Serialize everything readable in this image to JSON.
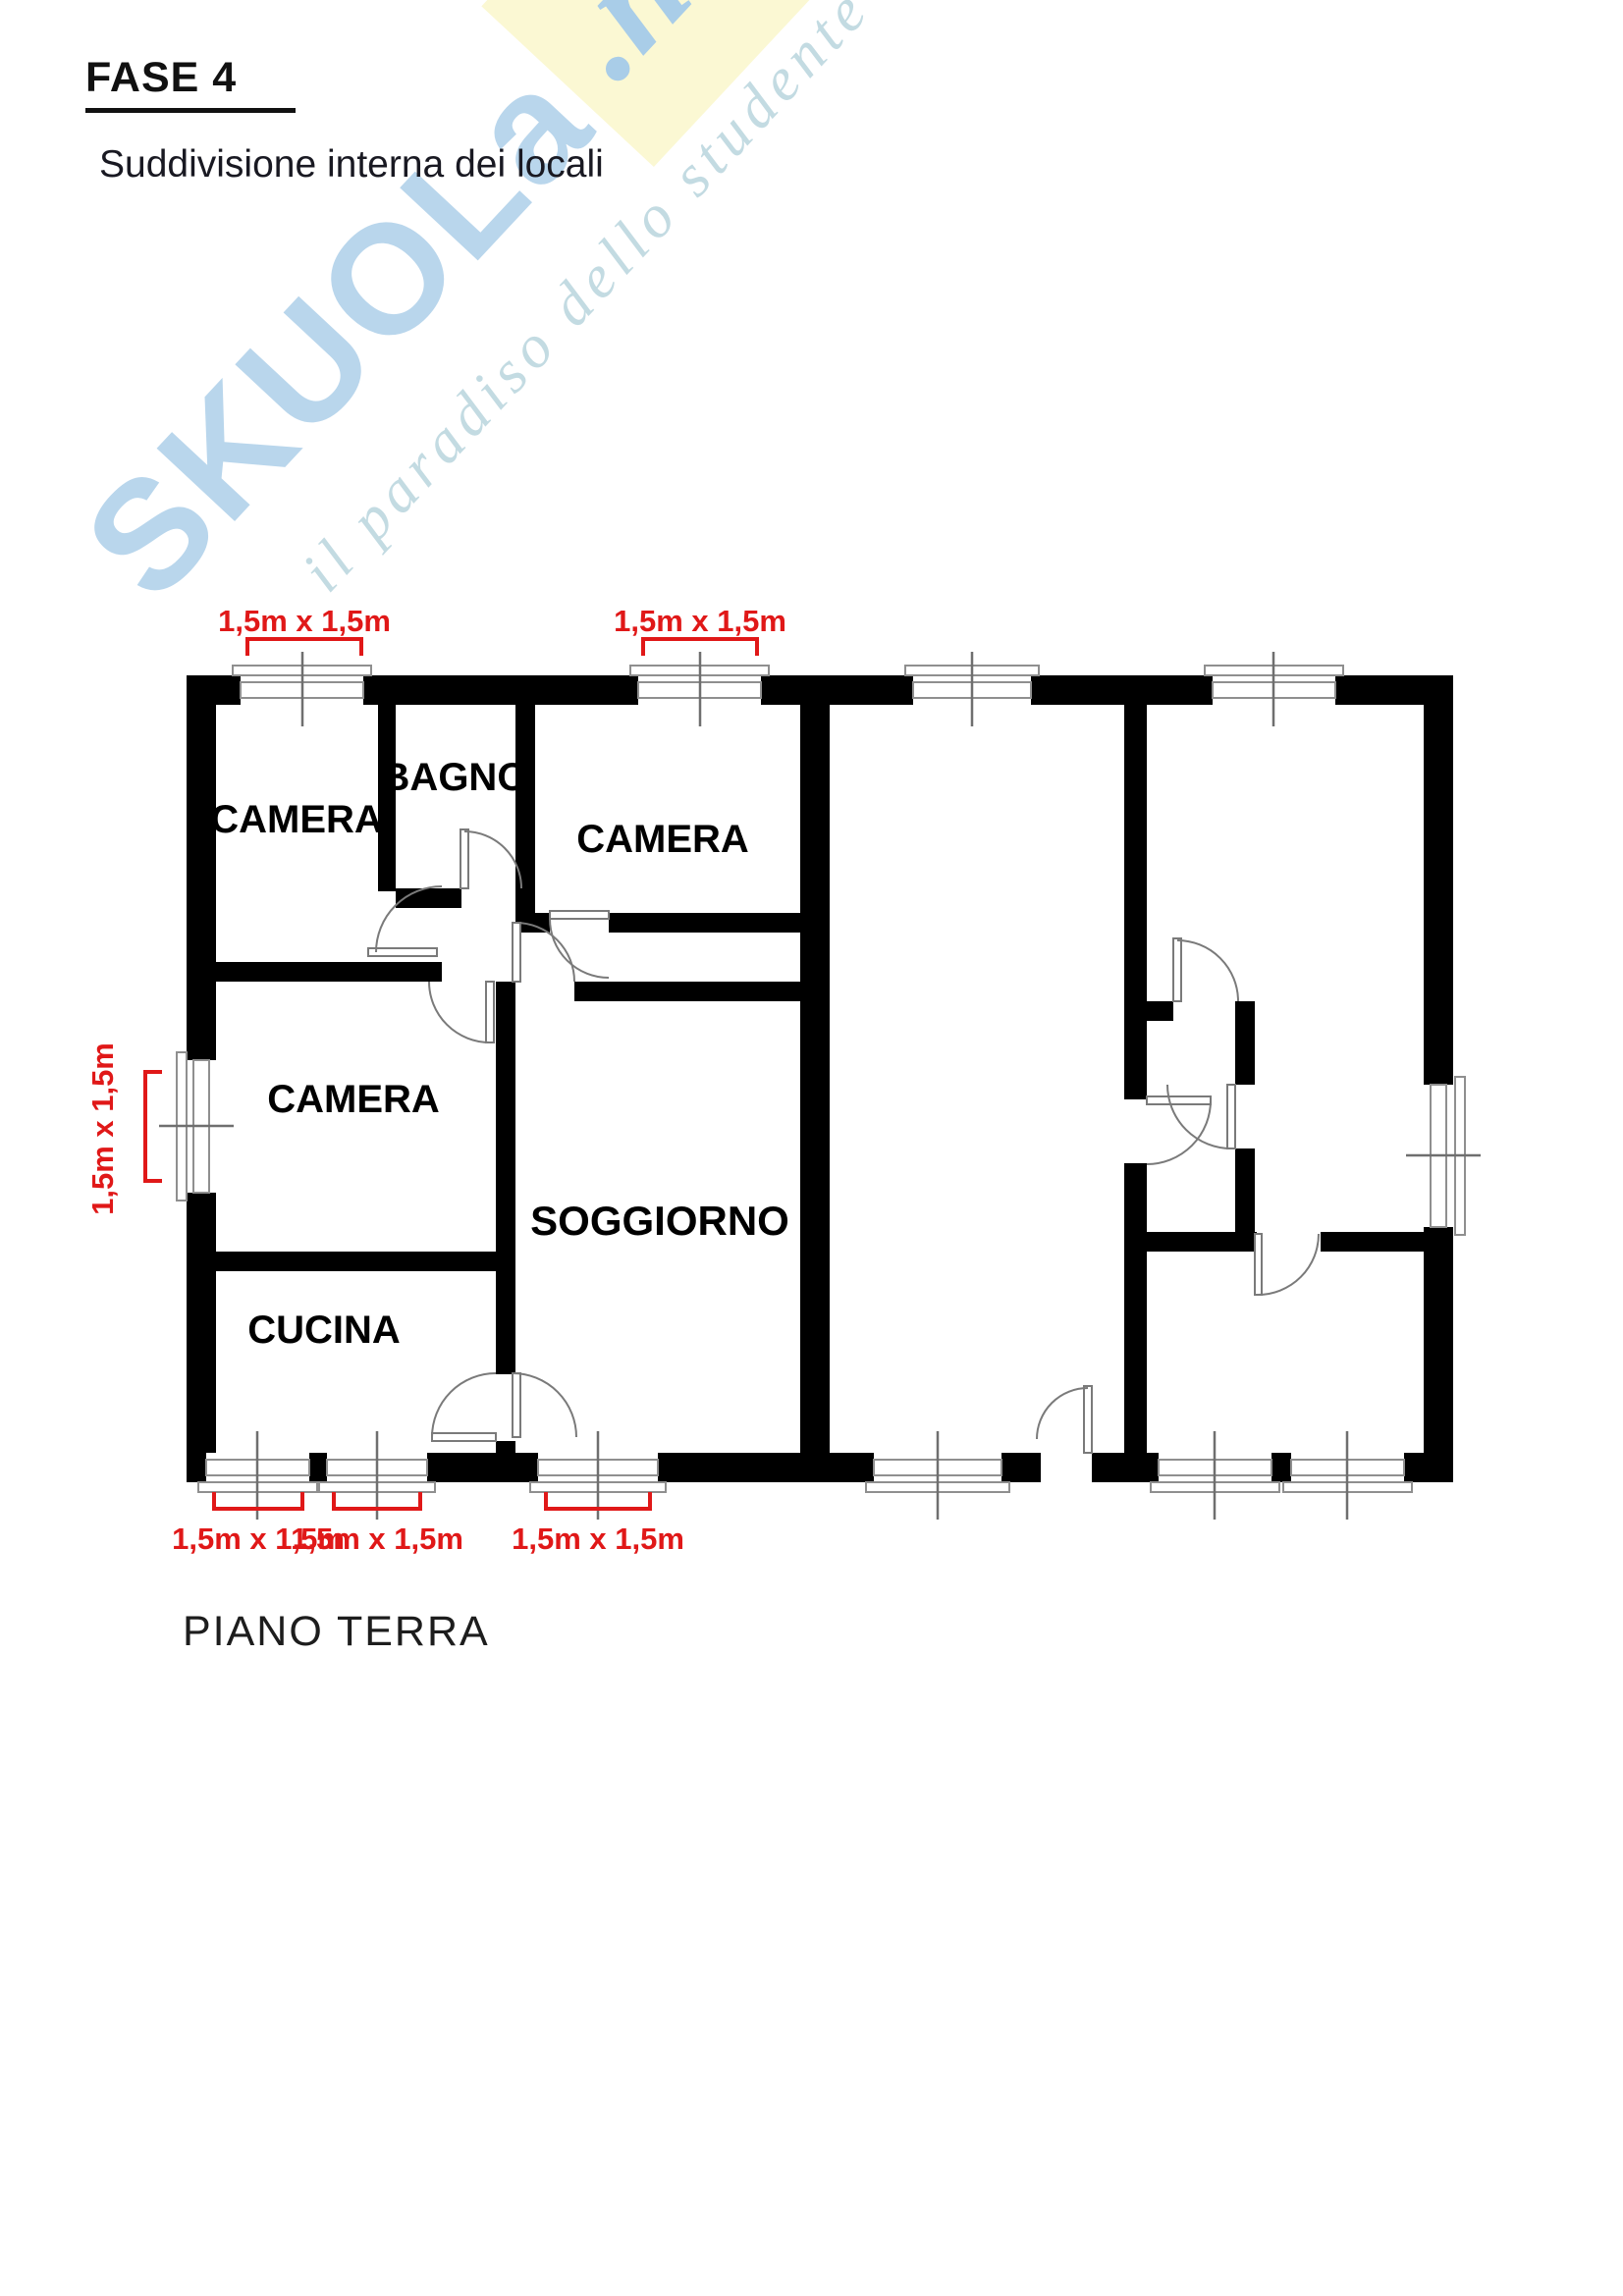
{
  "page": {
    "title": "FASE 4",
    "subtitle": "Suddivisione interna dei locali",
    "floor_label": "PIANO TERRA"
  },
  "watermark": {
    "brand": "SKUOLa",
    "tld": ".net",
    "tagline": "il paradiso dello studente",
    "brand_color": "#b9d6ec",
    "accent_color": "#fbf8d3"
  },
  "floor_plan": {
    "rooms": [
      {
        "label": "CAMERA"
      },
      {
        "label": "BAGNO"
      },
      {
        "label": "CAMERA"
      },
      {
        "label": "CAMERA"
      },
      {
        "label": "SOGGIORNO"
      },
      {
        "label": "CUCINA"
      }
    ],
    "dimension_labels": [
      {
        "text": "1,5m x 1,5m",
        "position": "top-window-1"
      },
      {
        "text": "1,5m x 1,5m",
        "position": "top-window-2"
      },
      {
        "text": "1,5m x 1,5m",
        "position": "left-window"
      },
      {
        "text": "1,5m x 1,5m",
        "position": "bottom-window-1"
      },
      {
        "text": "1,5m x 1,5m",
        "position": "bottom-window-2"
      },
      {
        "text": "1,5m x 1,5m",
        "position": "bottom-window-3"
      }
    ],
    "colors": {
      "wall": "#000000",
      "dimension_red": "#e01818",
      "thin_line": "#8f8f8f"
    }
  }
}
